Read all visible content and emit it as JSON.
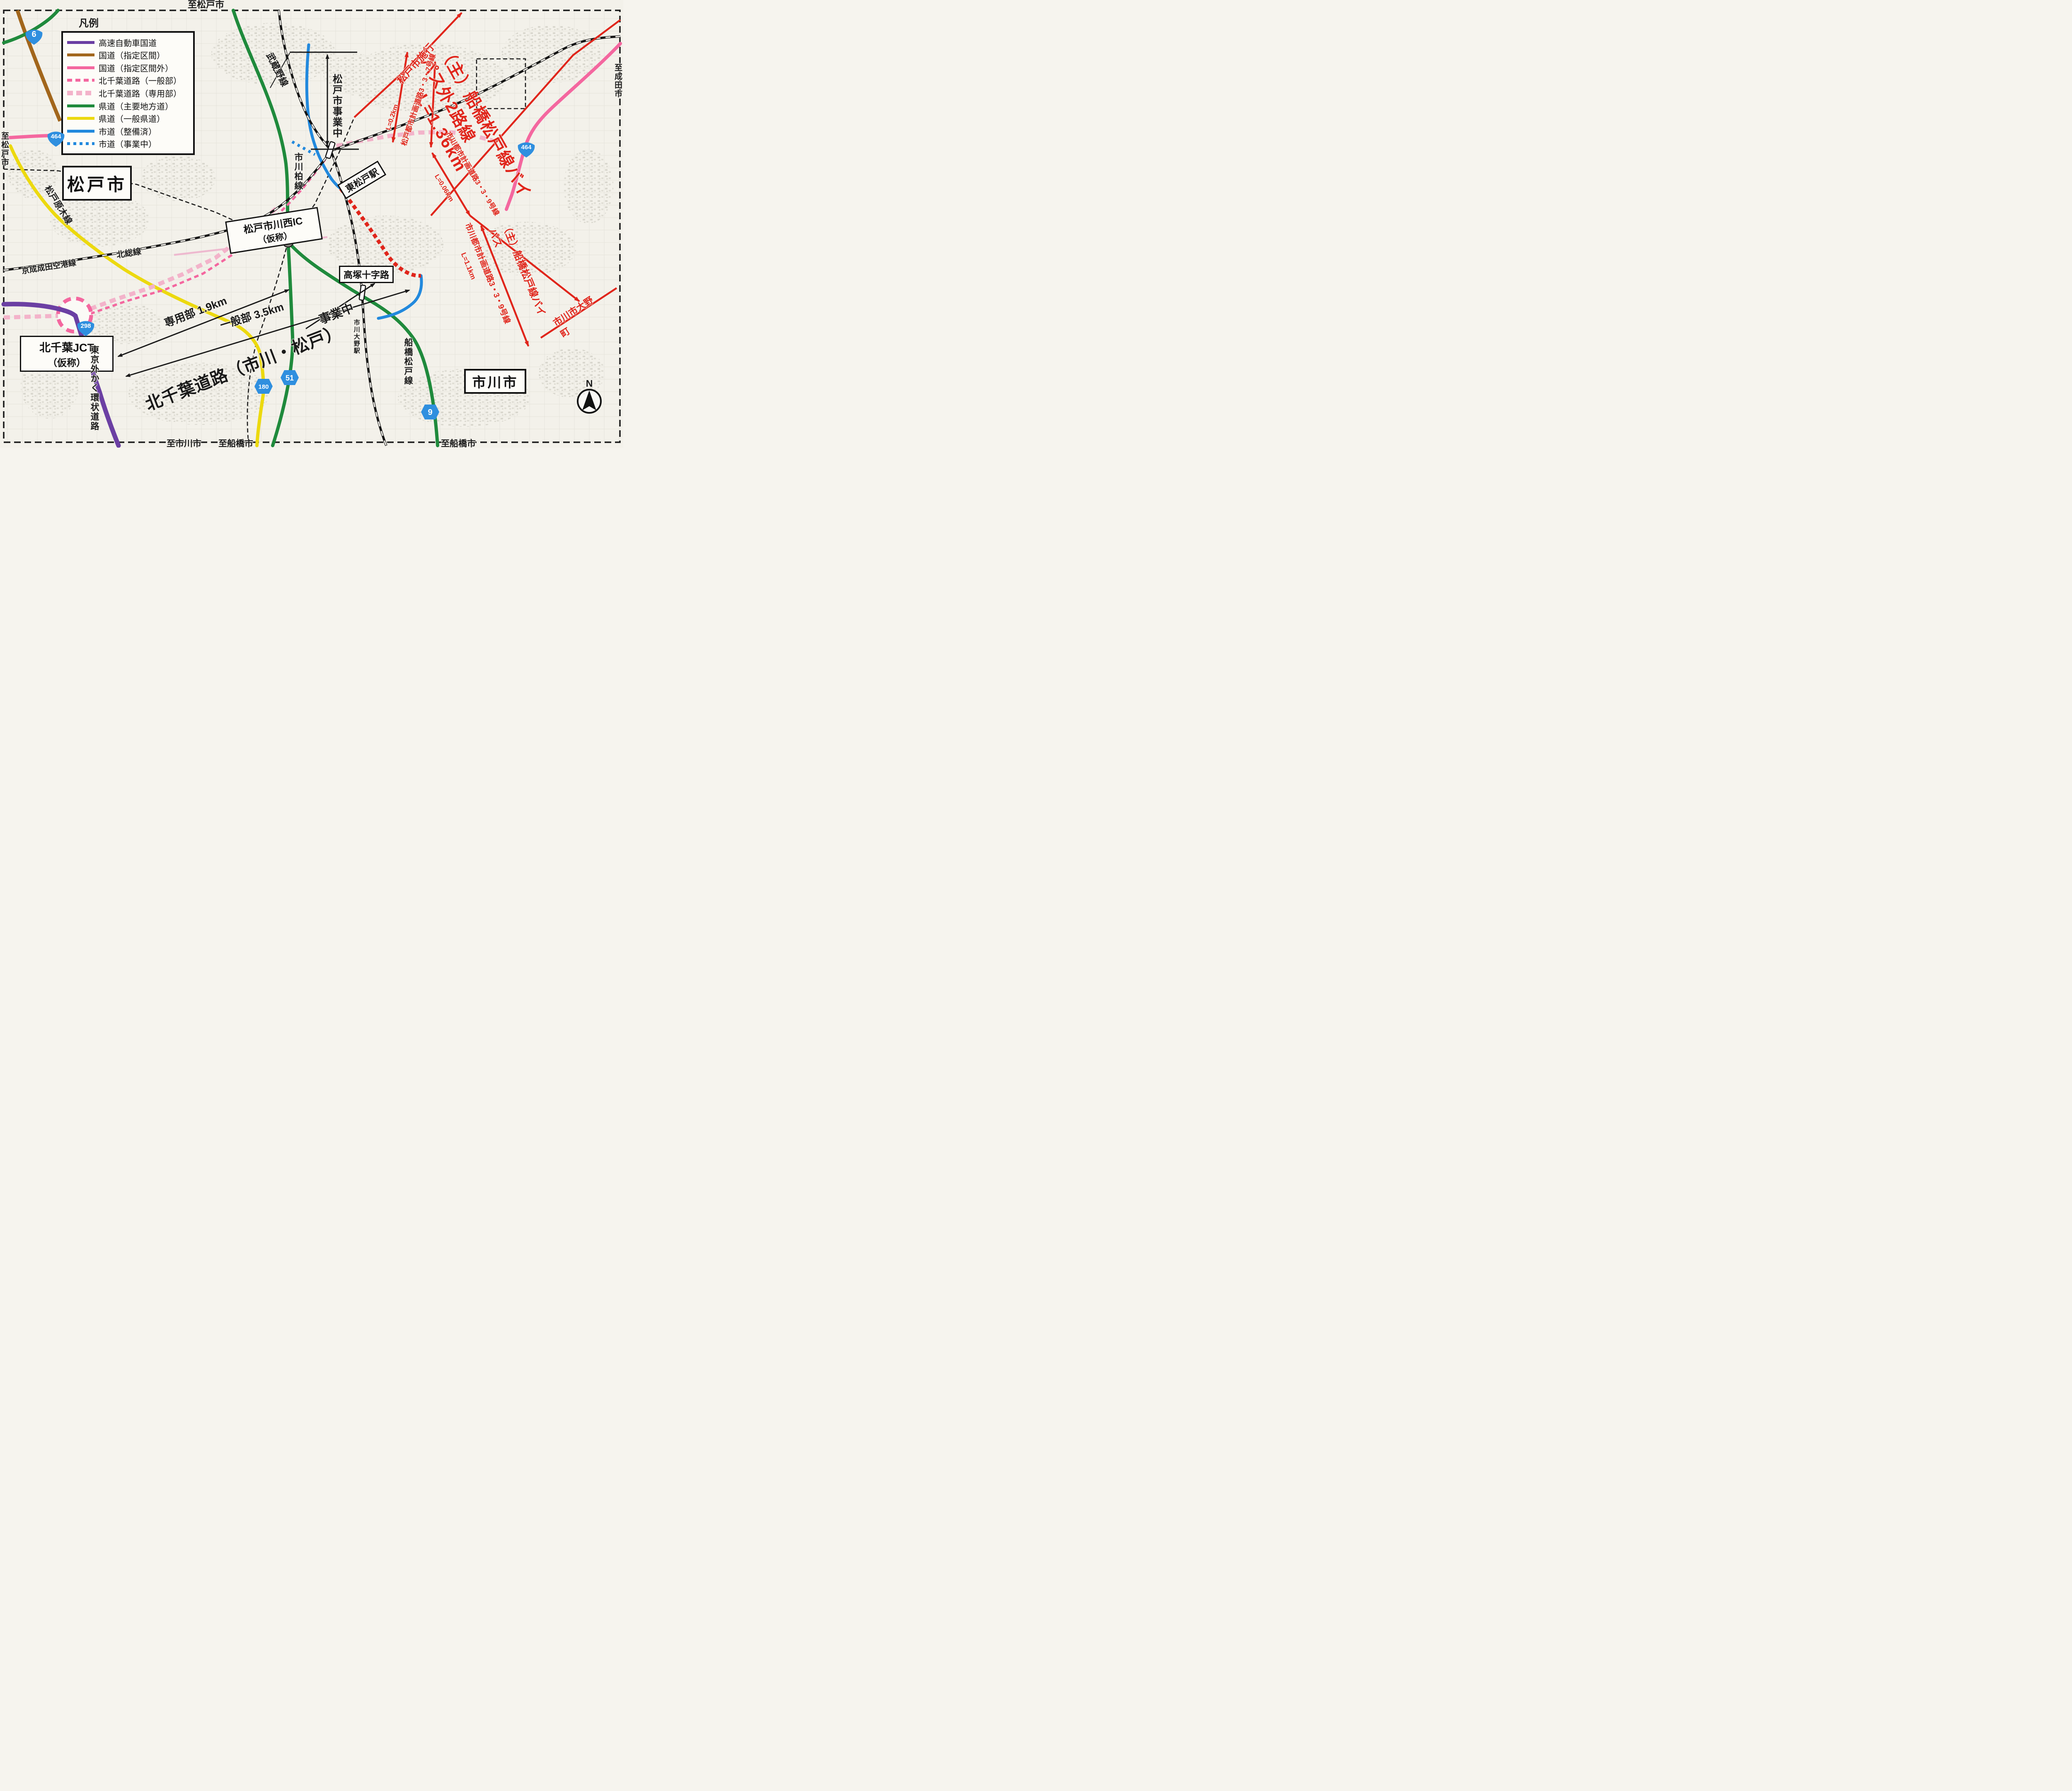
{
  "edge_labels": {
    "top": "至松戸市",
    "left": "至松戸市",
    "right": "至成田市",
    "bottom_left": "至市川市",
    "bottom_center": "至船橋市",
    "bottom_right": "至船橋市"
  },
  "legend": {
    "title": "凡例",
    "items": [
      {
        "label": "高速自動車国道",
        "style": "solid",
        "color": "#6b3fa3"
      },
      {
        "label": "国道（指定区間）",
        "style": "solid",
        "color": "#a2661c"
      },
      {
        "label": "国道（指定区間外）",
        "style": "solid",
        "color": "#f4679f"
      },
      {
        "label": "北千葉道路（一般部）",
        "style": "dashed",
        "color": "#f4679f"
      },
      {
        "label": "北千葉道路（専用部）",
        "style": "dashed",
        "color": "#f3b3ca"
      },
      {
        "label": "県道（主要地方道）",
        "style": "solid",
        "color": "#1f8a3c"
      },
      {
        "label": "県道（一般県道）",
        "style": "solid",
        "color": "#ecd90f"
      },
      {
        "label": "市道（整備済）",
        "style": "solid",
        "color": "#2289dd"
      },
      {
        "label": "市道（事業中）",
        "style": "dotted",
        "color": "#2289dd"
      }
    ]
  },
  "cities": {
    "matsudo": "松戸市",
    "ichikawa": "市川市"
  },
  "boxes": {
    "jct_line1": "北千葉JCT",
    "jct_line2": "（仮称）",
    "ic_line1": "松戸市川西IC",
    "ic_line2": "（仮称）",
    "takatsuka": "高塚十字路",
    "higashimatsudo_station": "東松戸駅"
  },
  "rail_road_labels": {
    "musashino": "武蔵野線",
    "hokuso": "北総線",
    "keisei": "京成成田空港線",
    "ichikawa_kashiwa": "市川柏線",
    "matsudo_baraki": "松戸原木線",
    "gaikan": "東京外かく環状道路",
    "funabashi_matsudo": "船橋松戸線",
    "ichikawa_ono_station": "市川大野駅",
    "matsudo_jigyochu": "松戸市事業中"
  },
  "black_annotations": {
    "senyobu": "専用部 1.9km",
    "ippanbu": "一般部 3.5km",
    "jigyochu": "事業中",
    "kitachiba": "北千葉道路（市川・松戸）"
  },
  "red_annotations": {
    "main_title": "（主）船橋松戸線バイパス外2路線",
    "main_length": "L=1.36km",
    "matsudo_shiko": "松戸市施行",
    "r337": "松戸都市計画道路3・3・7号線",
    "r337_len": "L=0.2km",
    "r339": "市川都市計画道路3・3・9号線",
    "r339_len": "L=0.06km",
    "bypass_small": "（主）船橋松戸線バイパス",
    "r339b": "市川都市計画道路3・3・9号線",
    "r339b_len": "L=1.1km",
    "ono": "市川市大野町"
  },
  "shields": {
    "r6": "6",
    "r298": "298",
    "r464a": "464",
    "r464b": "464",
    "p9": "9",
    "p51": "51",
    "p180": "180"
  },
  "compass": {
    "north": "N"
  },
  "colors": {
    "red_annotation": "#e0251b",
    "national_route_pink": "#f4679f",
    "kitachiba_senyobu_pink": "#f3b3ca",
    "prefectural_green": "#1f8a3c",
    "prefectural_yellow": "#ecd90f",
    "city_road_blue": "#2289dd",
    "expressway_purple": "#6b3fa3",
    "national_brown": "#a2661c",
    "shield_blue": "#2f8fdf",
    "map_background": "#f3f1ea",
    "line_black": "#1a1a1a"
  }
}
